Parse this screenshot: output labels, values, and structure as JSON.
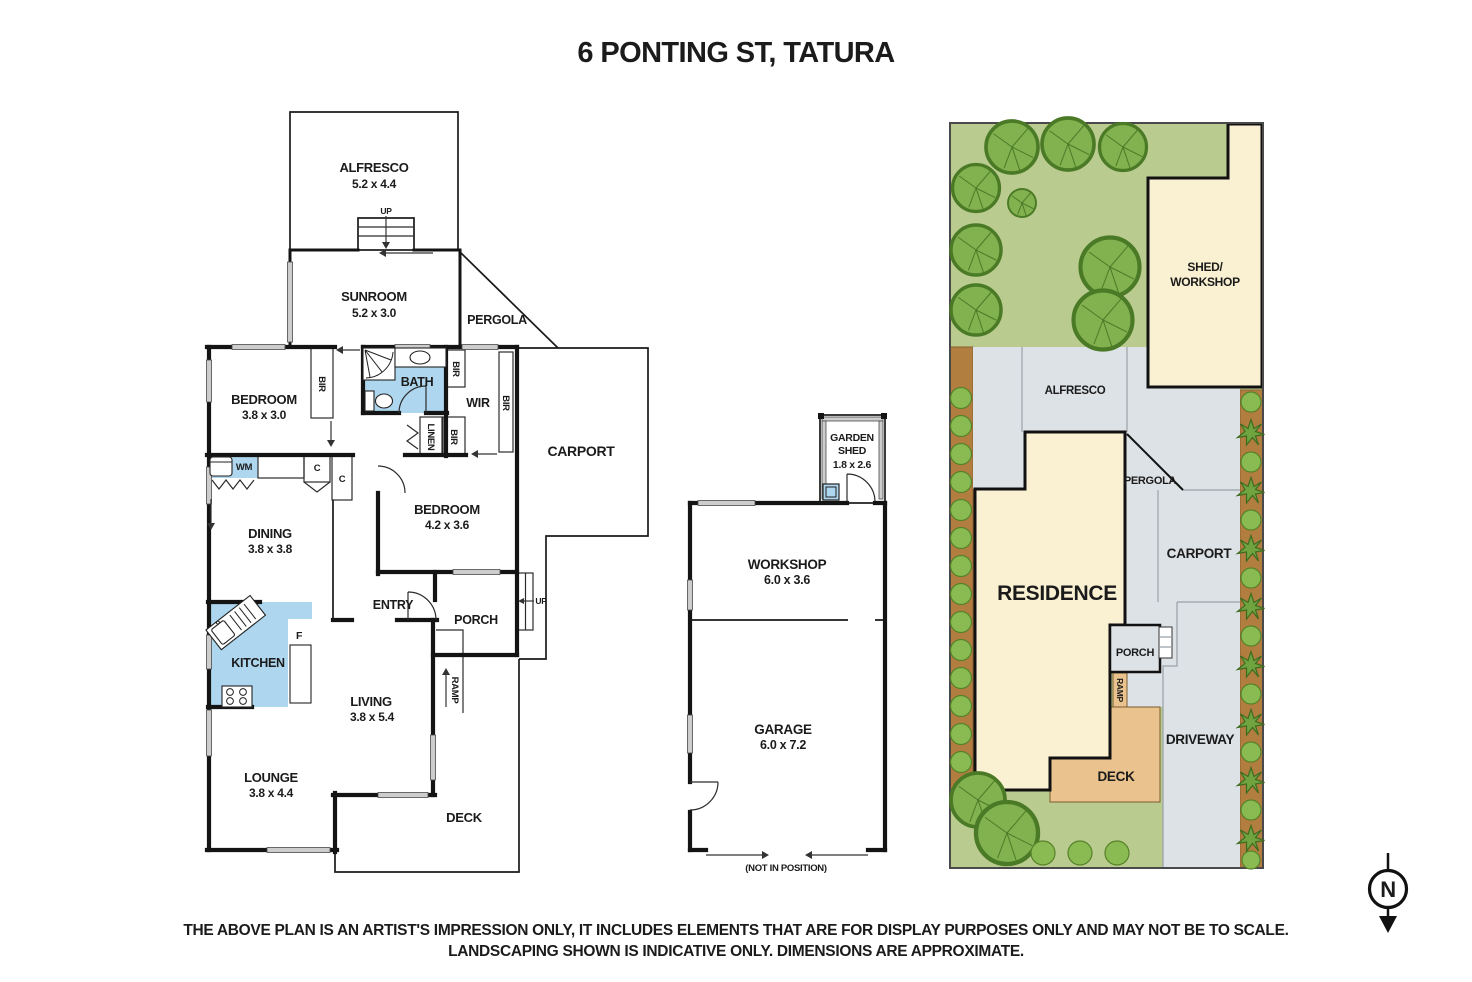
{
  "title": "6 PONTING ST, TATURA",
  "floorplan": {
    "alfresco": {
      "label": "ALFRESCO",
      "dims": "5.2 x 4.4"
    },
    "sunroom": {
      "label": "SUNROOM",
      "dims": "5.2 x 3.0"
    },
    "pergola": "PERGOLA",
    "bedroom1": {
      "label": "BEDROOM",
      "dims": "3.8 x 3.0"
    },
    "bath": "BATH",
    "wir": "WIR",
    "bir": "BIR",
    "linen": "LINEN",
    "bedroom2": {
      "label": "BEDROOM",
      "dims": "4.2 x 3.6"
    },
    "carport": "CARPORT",
    "dining": {
      "label": "DINING",
      "dims": "3.8 x 3.8"
    },
    "kitchen": "KITCHEN",
    "fridge": "F",
    "cupboard": "C",
    "wm": "WM",
    "entry": "ENTRY",
    "porch": "PORCH",
    "up": "UP",
    "living": {
      "label": "LIVING",
      "dims": "3.8 x 5.4"
    },
    "lounge": {
      "label": "LOUNGE",
      "dims": "3.8 x 4.4"
    },
    "ramp": "RAMP",
    "deck": "DECK"
  },
  "outbuilding": {
    "garden_shed": {
      "line1": "GARDEN",
      "line2": "SHED",
      "dims": "1.8 x 2.6"
    },
    "workshop": {
      "label": "WORKSHOP",
      "dims": "6.0 x 3.6"
    },
    "garage": {
      "label": "GARAGE",
      "dims": "6.0 x 7.2"
    },
    "note": "(NOT IN POSITION)"
  },
  "siteplan": {
    "shed_line1": "SHED/",
    "shed_line2": "WORKSHOP",
    "alfresco": "ALFRESCO",
    "pergola": "PERGOLA",
    "carport": "CARPORT",
    "residence": "RESIDENCE",
    "porch": "PORCH",
    "ramp": "RAMP",
    "deck": "DECK",
    "driveway": "DRIVEWAY"
  },
  "compass": {
    "north": "N"
  },
  "disclaimer": {
    "line1": "THE ABOVE PLAN IS AN ARTIST'S IMPRESSION ONLY, IT INCLUDES ELEMENTS THAT ARE FOR DISPLAY PURPOSES ONLY AND MAY NOT BE TO SCALE.",
    "line2": "LANDSCAPING SHOWN IS INDICATIVE ONLY. DIMENSIONS ARE APPROXIMATE."
  },
  "colors": {
    "wet_area_blue": "#aed7ef",
    "lawn_green": "#b9cb8e",
    "tree_green": "#82b14f",
    "building_cream": "#faf1d2",
    "paving_grey": "#dde2e6",
    "deck_tan": "#eac28e",
    "garden_bed_brown": "#b17e40",
    "wall_black": "#141414"
  }
}
